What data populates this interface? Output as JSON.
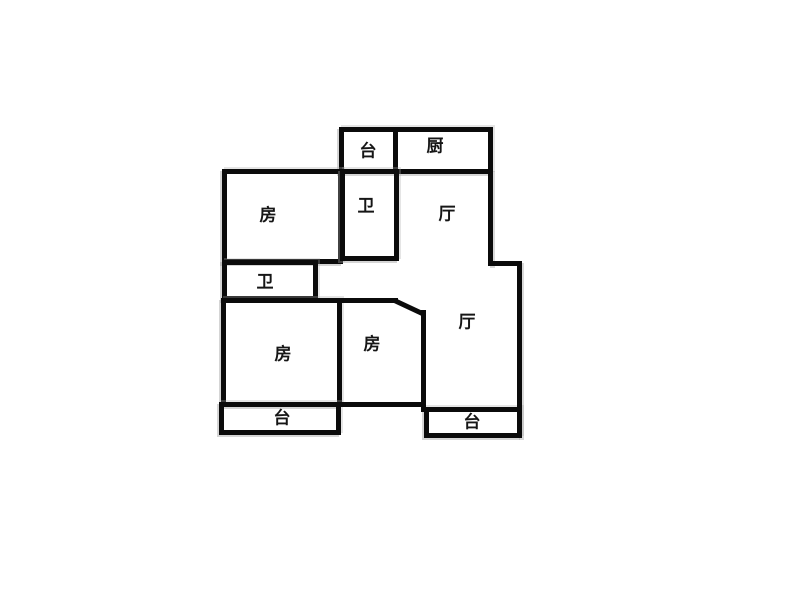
{
  "floorplan": {
    "colors": {
      "wall": "#0b0b0b",
      "background": "#ffffff",
      "label": "#161616",
      "scan_shadow": "#a0a0a0"
    },
    "rooms": {
      "balcony_top": {
        "label": "台"
      },
      "kitchen": {
        "label": "厨"
      },
      "bedroom_upper": {
        "label": "房"
      },
      "bath_upper": {
        "label": "卫"
      },
      "hall_upper": {
        "label": "厅"
      },
      "bath_middle": {
        "label": "卫"
      },
      "bedroom_left": {
        "label": "房"
      },
      "bedroom_middle": {
        "label": "房"
      },
      "hall_lower": {
        "label": "厅"
      },
      "balcony_left": {
        "label": "台"
      },
      "balcony_right": {
        "label": "台"
      }
    }
  }
}
